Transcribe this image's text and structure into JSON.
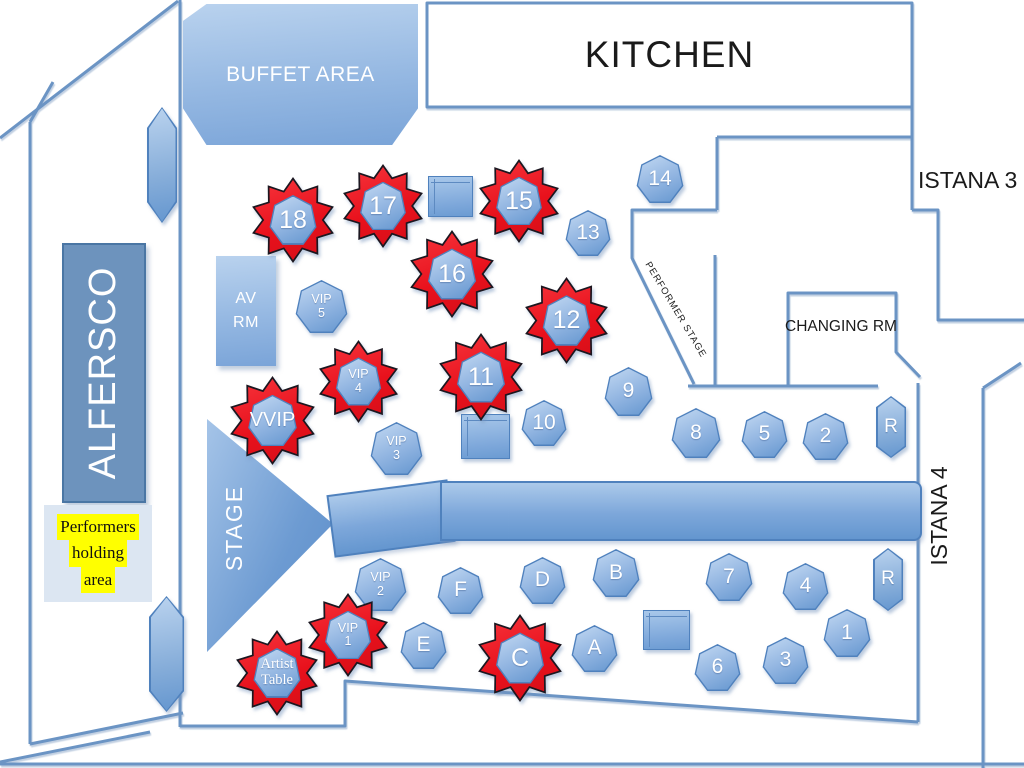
{
  "areas": {
    "buffet": {
      "label": "BUFFET AREA"
    },
    "kitchen": {
      "label": "KITCHEN"
    },
    "istana3": {
      "label": "ISTANA 3"
    },
    "istana4": {
      "label": "ISTANA 4"
    },
    "changing_room": {
      "label": "CHANGING RM"
    },
    "performer_stage": {
      "label": "PERFORMER STAGE"
    },
    "av_room": {
      "lines": [
        "AV",
        "RM"
      ]
    },
    "alfersco": {
      "label": "ALFERSCO"
    },
    "stage": {
      "label": "STAGE"
    },
    "performers_holding": {
      "lines": [
        "Performers",
        "holding",
        "area"
      ]
    }
  },
  "colors": {
    "wall": "#6b94c4",
    "table_border": "#4f81bd",
    "table_fill_top": "#bcd4f0",
    "table_fill_bottom": "#6496cf",
    "star_red": "#e8111c",
    "star_outline": "#1c1720",
    "highlight_yellow": "#ffff00",
    "holding_box": "#dce6f2"
  },
  "tables": [
    {
      "shape": "pillar",
      "name": "pillar",
      "x": 147,
      "y": 107,
      "w": 30,
      "h": 116,
      "click": false
    },
    {
      "shape": "pillar",
      "name": "pillar",
      "x": 149,
      "y": 596,
      "w": 35,
      "h": 116,
      "click": false
    },
    {
      "shape": "rect",
      "name": "service-table",
      "x": 428,
      "y": 176,
      "w": 43,
      "h": 39,
      "click": false
    },
    {
      "shape": "rect",
      "name": "service-table",
      "x": 461,
      "y": 414,
      "w": 47,
      "h": 43,
      "click": false
    },
    {
      "shape": "rect",
      "name": "service-table",
      "x": 643,
      "y": 610,
      "w": 45,
      "h": 38,
      "click": false
    },
    {
      "shape": "hept",
      "lines": [
        "14"
      ],
      "x": 636,
      "y": 155,
      "s": 48,
      "click": true
    },
    {
      "shape": "hept",
      "lines": [
        "13"
      ],
      "x": 565,
      "y": 210,
      "s": 46,
      "click": true
    },
    {
      "shape": "hept",
      "lines": [
        "VIP",
        "5"
      ],
      "fs": 12.5,
      "x": 295,
      "y": 280,
      "s": 53,
      "click": true
    },
    {
      "shape": "hept",
      "lines": [
        "VIP",
        "3"
      ],
      "fs": 12.5,
      "x": 370,
      "y": 422,
      "s": 53,
      "click": true
    },
    {
      "shape": "hept",
      "lines": [
        "VIP",
        "2"
      ],
      "fs": 12.5,
      "x": 354,
      "y": 558,
      "s": 53,
      "click": true
    },
    {
      "shape": "hept",
      "lines": [
        "9"
      ],
      "x": 604,
      "y": 367,
      "s": 49,
      "click": true
    },
    {
      "shape": "hept",
      "lines": [
        "10"
      ],
      "x": 521,
      "y": 400,
      "s": 46,
      "click": true
    },
    {
      "shape": "hept",
      "lines": [
        "8"
      ],
      "x": 671,
      "y": 408,
      "s": 50,
      "click": true
    },
    {
      "shape": "hept",
      "lines": [
        "5"
      ],
      "x": 741,
      "y": 411,
      "s": 47,
      "click": true
    },
    {
      "shape": "hept",
      "lines": [
        "2"
      ],
      "x": 802,
      "y": 413,
      "s": 47,
      "click": true
    },
    {
      "shape": "hept",
      "lines": [
        "F"
      ],
      "x": 437,
      "y": 567,
      "s": 47,
      "click": true
    },
    {
      "shape": "hept",
      "lines": [
        "D"
      ],
      "x": 519,
      "y": 557,
      "s": 47,
      "click": true
    },
    {
      "shape": "hept",
      "lines": [
        "B"
      ],
      "x": 592,
      "y": 549,
      "s": 48,
      "click": true
    },
    {
      "shape": "hept",
      "lines": [
        "E"
      ],
      "x": 400,
      "y": 622,
      "s": 47,
      "click": true
    },
    {
      "shape": "hept",
      "lines": [
        "A"
      ],
      "x": 571,
      "y": 625,
      "s": 47,
      "click": true
    },
    {
      "shape": "hept",
      "lines": [
        "7"
      ],
      "x": 705,
      "y": 553,
      "s": 48,
      "click": true
    },
    {
      "shape": "hept",
      "lines": [
        "4"
      ],
      "x": 782,
      "y": 563,
      "s": 47,
      "click": true
    },
    {
      "shape": "hept",
      "lines": [
        "1"
      ],
      "x": 823,
      "y": 609,
      "s": 48,
      "click": true
    },
    {
      "shape": "hept",
      "lines": [
        "6"
      ],
      "x": 694,
      "y": 644,
      "s": 47,
      "click": true
    },
    {
      "shape": "hept",
      "lines": [
        "3"
      ],
      "x": 762,
      "y": 637,
      "s": 47,
      "click": true
    },
    {
      "shape": "rbooth",
      "lines": [
        "R"
      ],
      "fs": 19,
      "x": 876,
      "y": 396,
      "w": 30,
      "h": 62,
      "click": true
    },
    {
      "shape": "rbooth",
      "lines": [
        "R"
      ],
      "fs": 19,
      "x": 873,
      "y": 548,
      "w": 30,
      "h": 63,
      "click": true
    },
    {
      "shape": "star",
      "lines": [
        "18"
      ],
      "x": 250,
      "y": 177,
      "s": 86,
      "click": true
    },
    {
      "shape": "star",
      "lines": [
        "17"
      ],
      "x": 341,
      "y": 164,
      "s": 84,
      "click": true
    },
    {
      "shape": "star",
      "lines": [
        "15"
      ],
      "x": 477,
      "y": 159,
      "s": 84,
      "click": true
    },
    {
      "shape": "star",
      "lines": [
        "16"
      ],
      "x": 408,
      "y": 230,
      "s": 88,
      "click": true
    },
    {
      "shape": "star",
      "lines": [
        "12"
      ],
      "x": 523,
      "y": 277,
      "s": 87,
      "click": true
    },
    {
      "shape": "star",
      "lines": [
        "11"
      ],
      "x": 437,
      "y": 333,
      "s": 88,
      "click": true
    },
    {
      "shape": "star",
      "lines": [
        "VVIP"
      ],
      "fs": 20,
      "x": 228,
      "y": 376,
      "s": 89,
      "click": true
    },
    {
      "shape": "star",
      "lines": [
        "VIP",
        "4"
      ],
      "fs": 12.5,
      "x": 317,
      "y": 340,
      "s": 83,
      "click": true
    },
    {
      "shape": "star",
      "lines": [
        "VIP",
        "1"
      ],
      "fs": 12.5,
      "x": 306,
      "y": 593,
      "s": 84,
      "click": true
    },
    {
      "shape": "star",
      "lines": [
        "C"
      ],
      "x": 476,
      "y": 614,
      "s": 88,
      "click": true
    },
    {
      "shape": "star",
      "lines": [
        "Artist",
        "Table"
      ],
      "fs": 14.5,
      "serif": true,
      "x": 234,
      "y": 630,
      "s": 86,
      "click": true
    }
  ]
}
